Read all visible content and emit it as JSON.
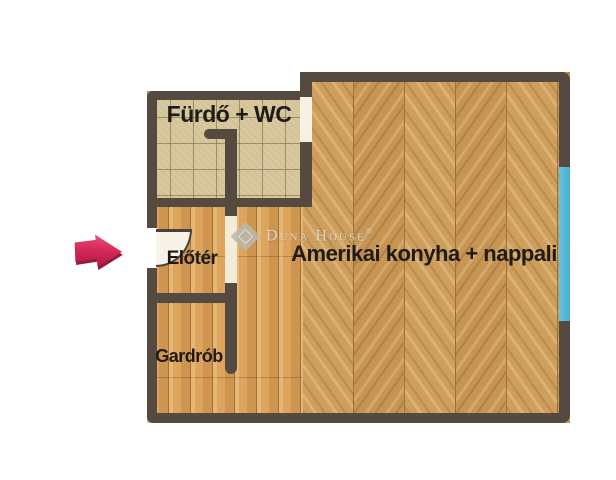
{
  "floorplan": {
    "rooms": {
      "bathroom": {
        "label": "Fürdő + WC",
        "floor": "tile"
      },
      "hall": {
        "label": "Előtér",
        "floor": "plank"
      },
      "wardrobe": {
        "label": "Gardrób",
        "floor": "plank"
      },
      "living": {
        "label": "Amerikai konyha + nappali",
        "floor": "herringbone"
      }
    },
    "watermark": {
      "brand": "Duna House",
      "registered": "®"
    },
    "colors": {
      "wall": "#544a40",
      "window": "#4fb6d9",
      "tile_floor": "#d7c89f",
      "plank_floor": "#dca45c",
      "herringbone_floor": "#c99a57",
      "entrance_arrow": "#c2184a",
      "label_text": "#1f1a15"
    },
    "icons": {
      "entrance_arrow": "right-arrow",
      "door_swing": "quarter-arc",
      "window_marker": "blue-strip",
      "brand_logo": "diamond"
    }
  }
}
